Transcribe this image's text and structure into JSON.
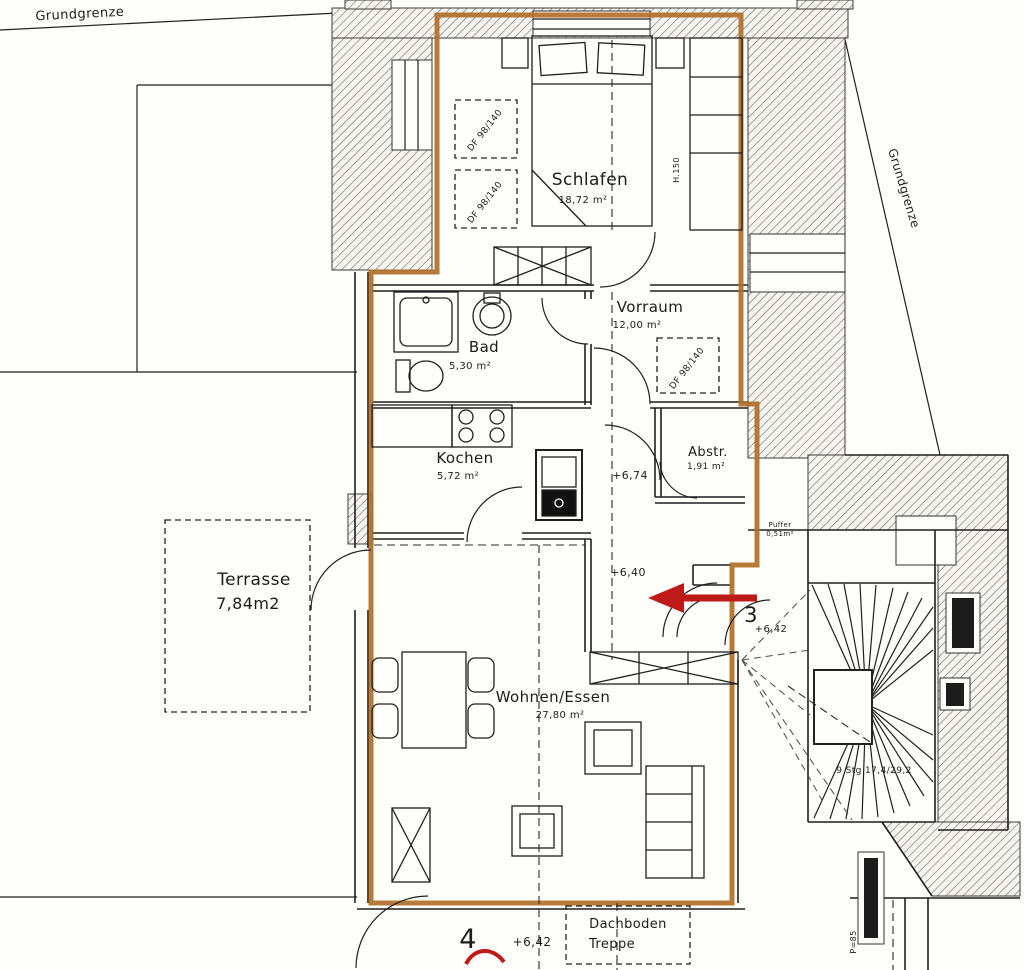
{
  "plan": {
    "boundaries": {
      "left": "Grundgrenze",
      "right": "Grundgrenze"
    },
    "rooms": {
      "schlafen": {
        "name": "Schlafen",
        "area": "18,72 m²"
      },
      "vorraum": {
        "name": "Vorraum",
        "area": "12,00 m²"
      },
      "bad": {
        "name": "Bad",
        "area": "5,30 m²"
      },
      "kochen": {
        "name": "Kochen",
        "area": "5,72 m²"
      },
      "abstr": {
        "name": "Abstr.",
        "area": "1,91 m²"
      },
      "terrasse": {
        "name": "Terrasse",
        "area": "7,84m2"
      },
      "wohnen_essen": {
        "name": "Wohnen/Essen",
        "area": "27,80 m²"
      }
    },
    "levels": {
      "hall": "+6,74",
      "living": "+6,40",
      "stair_landing": "+6,42",
      "bottom": "+6,42"
    },
    "annotations": {
      "roof_windows": [
        "DF 98/140",
        "DF 98/140",
        "DF 98/140"
      ],
      "height": "H.150",
      "stair_note": "9 Stg 17,4/29,2",
      "door_number": "3",
      "unit_number": "4",
      "attic_stairs": {
        "line1": "Dachboden",
        "line2": "Treppe"
      },
      "buffer": {
        "line1": "Puffer",
        "line2": "0,51m²"
      },
      "post": "P=85"
    },
    "colors": {
      "outline": "#b06f28",
      "arrow": "#bf1a1a",
      "ink": "#1f1f1f",
      "paper": "#fdfdfa"
    }
  }
}
